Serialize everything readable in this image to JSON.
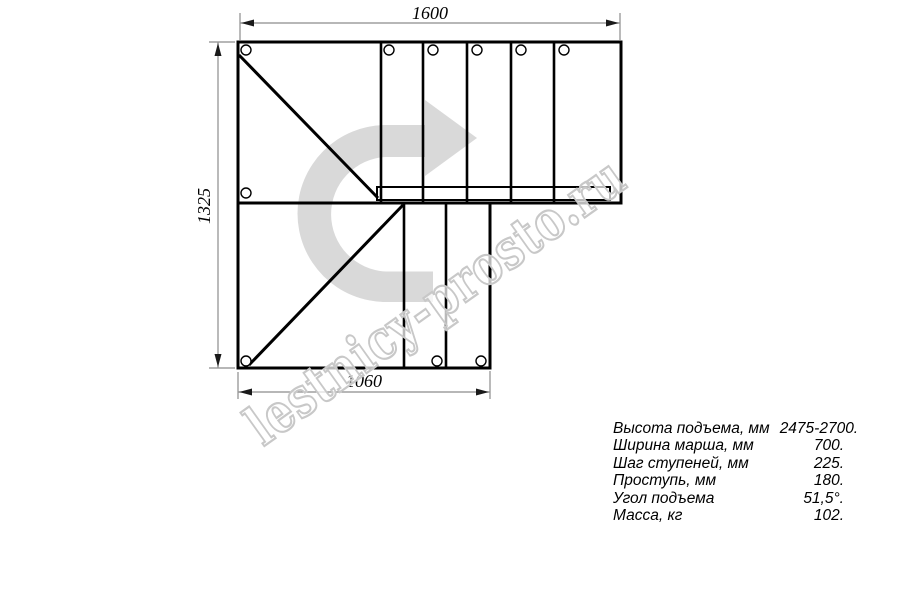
{
  "drawing": {
    "dimensions": {
      "top": "1600",
      "left": "1325",
      "bottom": "1060"
    }
  },
  "watermark": {
    "text": "lestnicy-prosto.ru"
  },
  "specs": {
    "rows": [
      {
        "label": "Высота подъема, мм",
        "value": "2475-2700."
      },
      {
        "label": "Ширина марша, мм",
        "value": "700."
      },
      {
        "label": "Шаг ступеней, мм",
        "value": "225."
      },
      {
        "label": "Проступь, мм",
        "value": "180."
      },
      {
        "label": "Угол подъема",
        "value": "51,5°."
      },
      {
        "label": "Масса, кг",
        "value": "102."
      }
    ]
  },
  "colors": {
    "line": "#000000",
    "dimension": "#8c8c8c",
    "arrow_fill": "#d9d9d9",
    "watermark_outline": "#c8c8c8",
    "background": "#ffffff"
  }
}
